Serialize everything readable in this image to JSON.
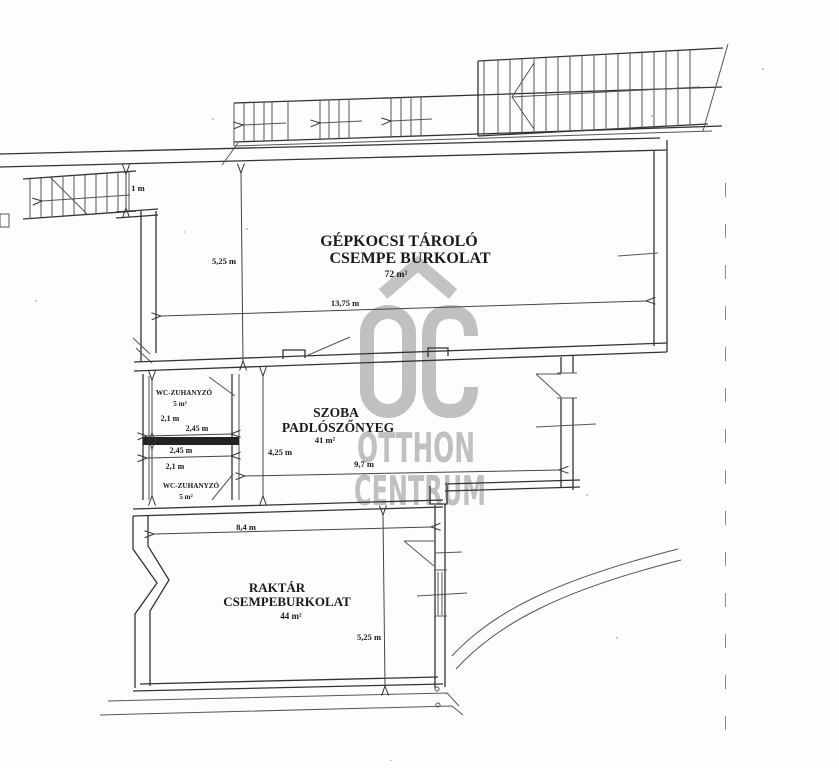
{
  "watermark": {
    "oc": "OC",
    "otthon": "OTTHON",
    "centrum": "CENTRUM"
  },
  "rooms": {
    "garage": {
      "line1": "GÉPKOCSI TÁROLÓ",
      "line2": "CSEMPE BURKOLAT",
      "area": "72 m²"
    },
    "szoba": {
      "line1": "SZOBA",
      "line2": "PADLÓSZŐNYEG",
      "area": "41 m²"
    },
    "raktar": {
      "line1": "RAKTÁR",
      "line2": "CSEMPEBURKOLAT",
      "area": "44 m²"
    },
    "wc_top": {
      "line1": "WC-ZUHANYZÓ",
      "area": "5 m²"
    },
    "wc_bottom": {
      "line1": "WC-ZUHANYZÓ",
      "area": "5 m²"
    }
  },
  "dims": {
    "stair_width": "1 m",
    "garage_height": "5,25 m",
    "garage_width": "13,75 m",
    "wc_top_height": "2,1 m",
    "wc_top_width": "2,45 m",
    "wc_bottom_width": "2,45 m",
    "wc_bottom_height": "2,1 m",
    "szoba_height": "4,25 m",
    "szoba_width": "9,7 m",
    "raktar_width": "8,4 m",
    "raktar_height": "5,25 m"
  },
  "colors": {
    "line": "#333333",
    "watermark": "#c0c0c0",
    "background": "#fdfdfc"
  }
}
